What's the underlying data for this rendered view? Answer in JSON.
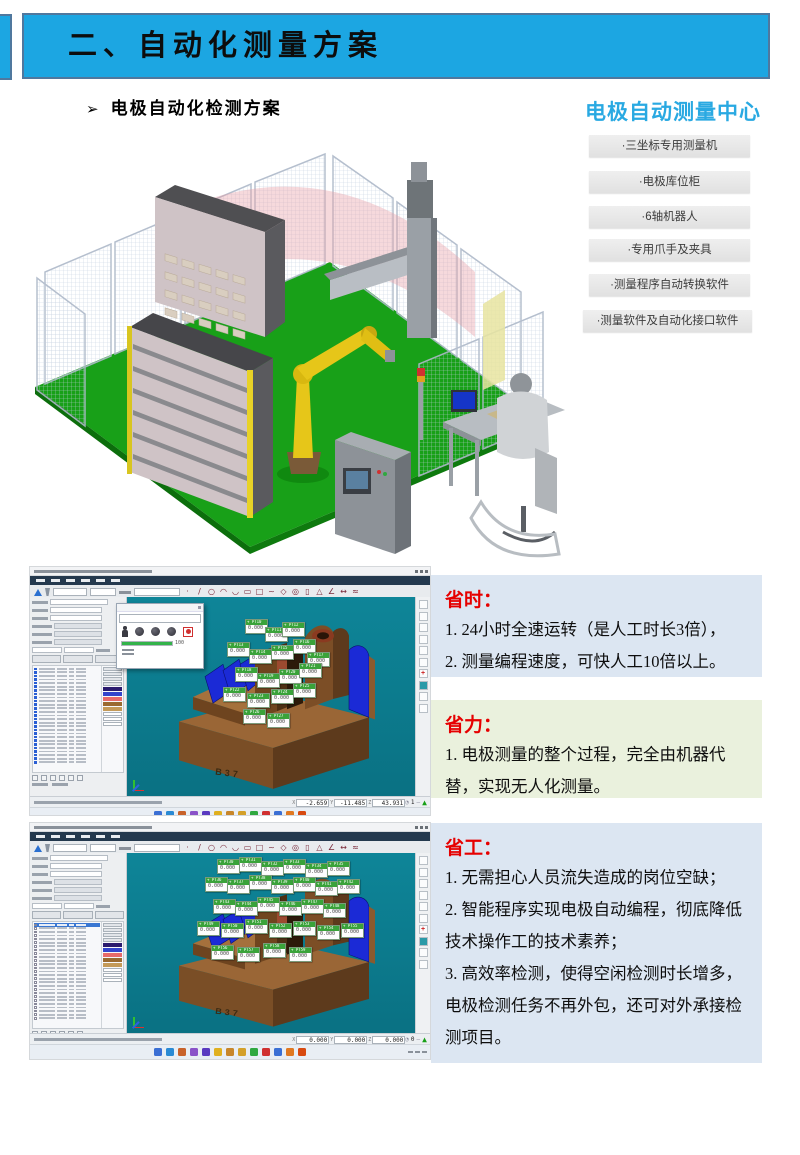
{
  "banner": {
    "label": "二、自动化测量方案"
  },
  "subtitle": {
    "arrow": "➢",
    "label": "电极自动化检测方案"
  },
  "solution_panel": {
    "title": "电极自动测量中心",
    "items": [
      "·三坐标专用测量机",
      "·电极库位柜",
      "·6轴机器人",
      "·专用爪手及夹具",
      "·测量程序自动转换软件",
      "·测量软件及自动化接口软件"
    ]
  },
  "benefits": [
    {
      "title": "省时：",
      "bg": "blue",
      "lines": [
        "1. 24小时全速运转（是人工时长3倍），",
        "2. 测量编程速度，可快人工10倍以上。"
      ]
    },
    {
      "title": "省力：",
      "bg": "green",
      "lines": [
        "1. 电极测量的整个过程，完全由机器代替，实现无人化测量。"
      ]
    },
    {
      "title": "省工：",
      "bg": "blue",
      "lines": [
        "1. 无需担心人员流失造成的岗位空缺；",
        "2. 智能程序实现电极自动编程，彻底降低技术操作工的技术素养；",
        "3. 高效率检测，使得空闲检测时长增多，电极检测任务不再外包，还可对外承接检测项目。"
      ]
    }
  ],
  "colors": {
    "banner_blue": "#1CA6E2",
    "panel_title_blue": "#29A9E2",
    "benefit_blue_bg": "#DCE6F2",
    "benefit_green_bg": "#EAF1DD",
    "benefit_title_red": "#E60000",
    "viewport_teal": "#0C8092",
    "floor_green": "#17A017",
    "robot_yellow": "#E6C619",
    "tag_green": "#3AA33A"
  },
  "cmm": {
    "part_label": "B37",
    "tag_prefix": "PT",
    "tag_value": "0.000",
    "dialog": {
      "progress_label": "100"
    },
    "status_axis_labels": [
      "X",
      "Y",
      "Z"
    ],
    "toolbar_feature_icons": [
      "point",
      "line",
      "circle",
      "arc",
      "ellipse",
      "slot",
      "rect",
      "curve",
      "plane",
      "sphere",
      "cylinder",
      "cone",
      "angle",
      "distance",
      "scan"
    ],
    "right_strip_icons": [
      "zoom",
      "fit",
      "rotate",
      "pan",
      "select",
      "view-box",
      "coord-red",
      "probe-teal",
      "target",
      "grid"
    ],
    "table_rows": 27,
    "swatches": [
      "#2a1a6e",
      "#3344cc",
      "#e86a6a",
      "#9a6a30",
      "#c49a58"
    ],
    "taskbar_colors": [
      "#3b6fd4",
      "#2a8ad4",
      "#c8622a",
      "#8a52c8",
      "#5a3ac0",
      "#e0b020",
      "#c8862a",
      "#d4a02a",
      "#30a840",
      "#d03030",
      "#3b6fd4",
      "#e07820",
      "#d84a10"
    ],
    "screens": [
      {
        "name": "inspect-top",
        "status_x": "-2.659",
        "status_y": "-11.485",
        "status_z": "43.931",
        "status_n": "1",
        "has_dialog": true,
        "taskbar_clipped": true,
        "checkbox_rows": false,
        "tag_start": 10,
        "tags": [
          [
            118,
            22
          ],
          [
            138,
            30
          ],
          [
            155,
            25
          ],
          [
            100,
            45
          ],
          [
            122,
            52
          ],
          [
            144,
            48
          ],
          [
            166,
            42
          ],
          [
            180,
            55
          ],
          [
            108,
            70
          ],
          [
            130,
            76
          ],
          [
            152,
            72
          ],
          [
            172,
            66
          ],
          [
            96,
            90
          ],
          [
            120,
            96
          ],
          [
            144,
            92
          ],
          [
            166,
            86
          ],
          [
            116,
            112
          ],
          [
            140,
            116
          ]
        ]
      },
      {
        "name": "inspect-bottom",
        "status_x": "0.000",
        "status_y": "0.000",
        "status_z": "0.000",
        "status_n": "0",
        "has_dialog": false,
        "taskbar_clipped": false,
        "checkbox_rows": true,
        "tag_start": 30,
        "tags": [
          [
            90,
            6
          ],
          [
            112,
            4
          ],
          [
            134,
            8
          ],
          [
            156,
            6
          ],
          [
            178,
            10
          ],
          [
            200,
            8
          ],
          [
            78,
            24
          ],
          [
            100,
            26
          ],
          [
            122,
            22
          ],
          [
            144,
            26
          ],
          [
            166,
            24
          ],
          [
            188,
            28
          ],
          [
            210,
            26
          ],
          [
            86,
            46
          ],
          [
            108,
            48
          ],
          [
            130,
            44
          ],
          [
            152,
            48
          ],
          [
            174,
            46
          ],
          [
            196,
            50
          ],
          [
            70,
            68
          ],
          [
            94,
            70
          ],
          [
            118,
            66
          ],
          [
            142,
            70
          ],
          [
            166,
            68
          ],
          [
            190,
            72
          ],
          [
            214,
            70
          ],
          [
            84,
            92
          ],
          [
            110,
            94
          ],
          [
            136,
            90
          ],
          [
            162,
            94
          ]
        ]
      }
    ]
  }
}
